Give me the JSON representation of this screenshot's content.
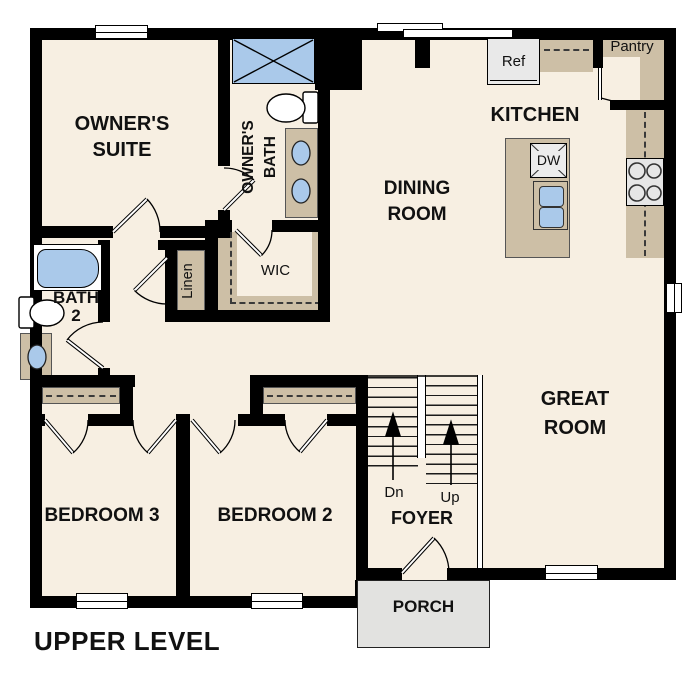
{
  "plan": {
    "title": "UPPER LEVEL"
  },
  "rooms": {
    "owners_suite": "OWNER'S\nSUITE",
    "owners_bath": "OWNER'S\nBATH",
    "kitchen": "KITCHEN",
    "dining_room": "DINING\nROOM",
    "great_room": "GREAT\nROOM",
    "bedroom3": "BEDROOM 3",
    "bedroom2": "BEDROOM 2",
    "bath2": "BATH\n2",
    "wic": "WIC",
    "linen": "Linen",
    "pantry": "Pantry",
    "foyer": "FOYER",
    "porch": "PORCH"
  },
  "fixtures": {
    "refrigerator": "Ref",
    "dishwasher": "DW"
  },
  "stairs": {
    "down": "Dn",
    "up": "Up"
  },
  "colors": {
    "floor": "#f7efe2",
    "wall": "#000000",
    "cabinet": "#cdbfa6",
    "water": "#aac9ea",
    "appliance": "#e9e9e9",
    "porch": "#e2e2e0"
  }
}
